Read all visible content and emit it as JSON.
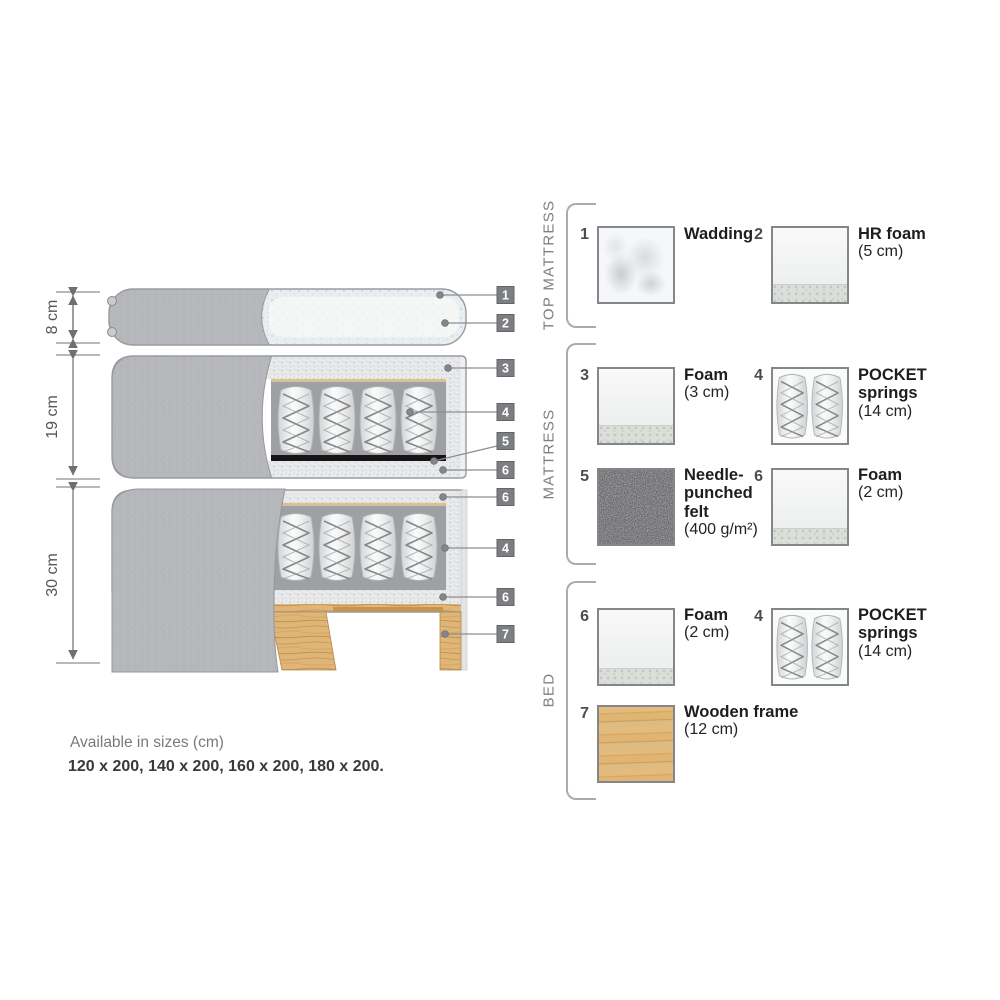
{
  "diagram": {
    "dimensions": [
      {
        "label": "8 cm"
      },
      {
        "label": "19 cm"
      },
      {
        "label": "30 cm"
      }
    ],
    "callouts": [
      "1",
      "2",
      "3",
      "4",
      "5",
      "6",
      "6",
      "4",
      "6",
      "7"
    ]
  },
  "legend": {
    "groups": [
      {
        "label": "TOP MATTRESS",
        "items": [
          {
            "num": "1",
            "name": "Wadding",
            "detail": ""
          },
          {
            "num": "2",
            "name": "HR foam",
            "detail": "(5 cm)"
          }
        ]
      },
      {
        "label": "MATTRESS",
        "items": [
          {
            "num": "3",
            "name": "Foam",
            "detail": "(3 cm)"
          },
          {
            "num": "4",
            "name": "POCKET springs",
            "detail": "(14 cm)"
          },
          {
            "num": "5",
            "name": "Needle-punched felt",
            "detail": "(400 g/m²)"
          },
          {
            "num": "6",
            "name": "Foam",
            "detail": "(2 cm)"
          }
        ]
      },
      {
        "label": "BED",
        "items": [
          {
            "num": "6",
            "name": "Foam",
            "detail": "(2 cm)"
          },
          {
            "num": "4",
            "name": "POCKET springs",
            "detail": "(14 cm)"
          },
          {
            "num": "7",
            "name": "Wooden frame",
            "detail": "(12 cm)"
          }
        ]
      }
    ]
  },
  "footer": {
    "line1": "Available in sizes (cm)",
    "line2": "120 x 200, 140 x 200, 160 x 200, 180 x 200."
  },
  "colors": {
    "callout_badge": "#7d7e82",
    "wood": "#e0b678",
    "fabric_cover": "#b6b7bb",
    "felt": "#58595b",
    "ticking": "#e8eaeb",
    "muted_text": "#7d7f82"
  }
}
